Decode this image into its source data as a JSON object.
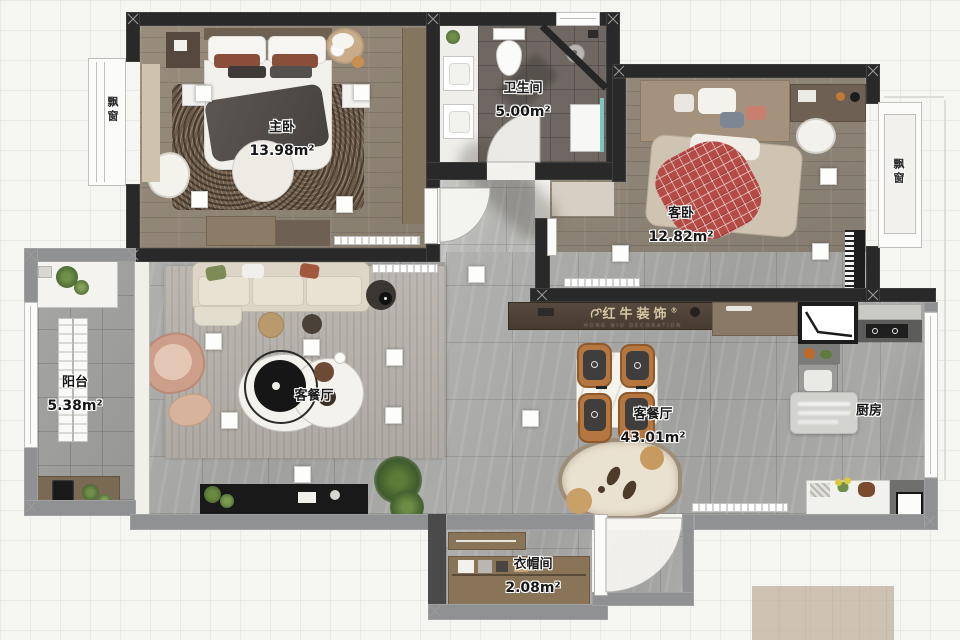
{
  "plan": {
    "rooms": [
      {
        "name": "主卧",
        "area": "13.98m²"
      },
      {
        "name": "卫生间",
        "area": "5.00m²"
      },
      {
        "name": "客卧",
        "area": "12.82m²"
      },
      {
        "name": "阳台",
        "area": "5.38m²"
      },
      {
        "name": "客餐厅",
        "area": "43.01m²"
      },
      {
        "name": "客餐厅",
        "area": ""
      },
      {
        "name": "厨房",
        "area": ""
      },
      {
        "name": "衣帽间",
        "area": "2.08m²"
      }
    ],
    "bay_window_left": "飘窗",
    "bay_window_right": "飘窗",
    "watermark": {
      "brand": "红牛装饰",
      "registered": "®",
      "tagline": "HONG NIU DECORATION"
    },
    "colors": {
      "wall_dark": "#292929",
      "wall_gray": "#8f9193",
      "label_text": "#171717",
      "watermark_gold": "#d8c7a3",
      "plaid_red": "#b44c45",
      "wood_floor": "#93897a",
      "tile_floor": "#a9a9a7"
    }
  }
}
